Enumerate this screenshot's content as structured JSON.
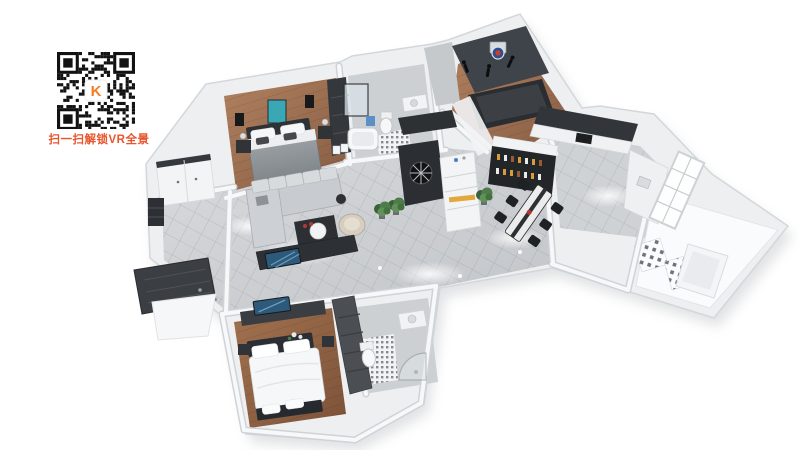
{
  "page": {
    "background": "#ffffff"
  },
  "qr": {
    "caption": "扫一扫解锁VR全景",
    "caption_color": "#e8542c",
    "logo_text": "K",
    "logo_color": "#f47c20"
  },
  "colors": {
    "wall": "#edeff1",
    "wall_edge": "#d4d7da",
    "marble_floor": "#ccd0d4",
    "wood_floor": "#9c6e50",
    "dark_furniture": "#303336",
    "sofa": "#c8ccd0",
    "teal_art": "#3aa7b5",
    "yellow_accent": "#e2a83b",
    "plant_green": "#4c7c4a",
    "tv_screen": "#2d5a7a"
  },
  "floorplan": {
    "rooms": [
      {
        "name": "secondary-bedroom"
      },
      {
        "name": "bathroom"
      },
      {
        "name": "kids-room"
      },
      {
        "name": "kitchen"
      },
      {
        "name": "dining-room"
      },
      {
        "name": "living-room"
      },
      {
        "name": "entry-foyer"
      },
      {
        "name": "master-bedroom"
      },
      {
        "name": "master-ensuite"
      },
      {
        "name": "utility-wing"
      }
    ]
  }
}
